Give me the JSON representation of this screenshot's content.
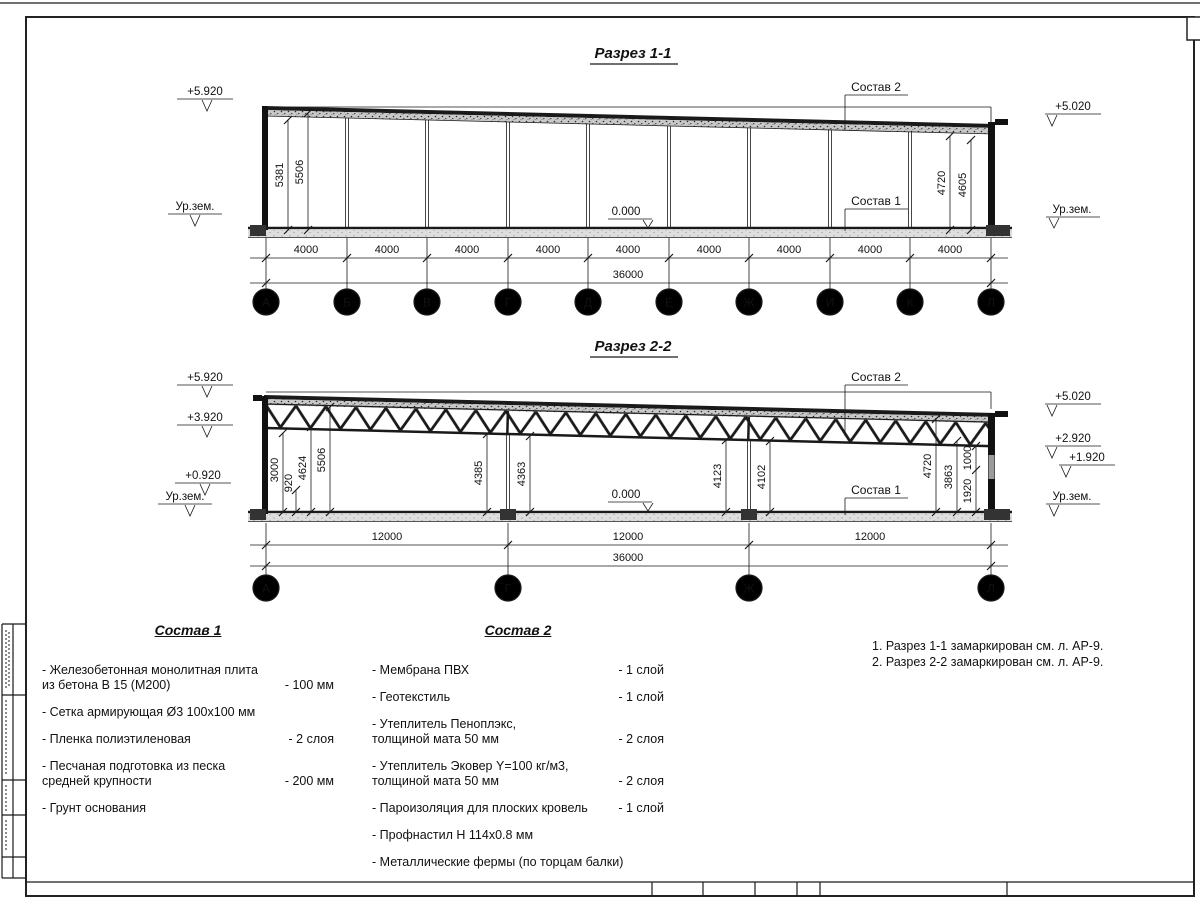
{
  "s1": {
    "title": "Разрез 1-1",
    "elev": {
      "left_top": "+5.920",
      "left_ground": "Ур.зем.",
      "right_top": "+5.020",
      "right_ground": "Ур.зем."
    },
    "zero": "0.000",
    "roof_label": "Состав 2",
    "floor_label": "Состав 1",
    "vdims": {
      "d5381": "5381",
      "d5506": "5506",
      "d4720": "4720",
      "d4605": "4605"
    },
    "bays": [
      "4000",
      "4000",
      "4000",
      "4000",
      "4000",
      "4000",
      "4000",
      "4000",
      "4000"
    ],
    "total": "36000",
    "axes": [
      "А",
      "Б",
      "В",
      "Г",
      "Д",
      "Е",
      "Ж",
      "И",
      "К",
      "Л"
    ]
  },
  "s2": {
    "title": "Разрез 2-2",
    "elev": {
      "left": [
        "+5.920",
        "+3.920",
        "+0.920"
      ],
      "left_ground": "Ур.зем.",
      "right": [
        "+5.020",
        "+2.920",
        "+1.920"
      ],
      "right_ground": "Ур.зем."
    },
    "zero": "0.000",
    "roof_label": "Состав 2",
    "floor_label": "Состав 1",
    "vdims": [
      "3000",
      "920",
      "4624",
      "5506",
      "4385",
      "4363",
      "4123",
      "4102",
      "4720",
      "3863",
      "1000",
      "1920"
    ],
    "bays": [
      "12000",
      "12000",
      "12000"
    ],
    "total": "36000",
    "axes": [
      "А",
      "Г",
      "Ж",
      "Л"
    ]
  },
  "sostav1": {
    "title": "Состав 1",
    "items": [
      {
        "name": "- Железобетонная  монолитная плита\nиз бетона В 15 (М200)",
        "value": "- 100 мм"
      },
      {
        "name": "- Сетка армирующая Ø3 100x100 мм",
        "value": ""
      },
      {
        "name": "- Пленка полиэтиленовая",
        "value": "- 2 слоя"
      },
      {
        "name": "- Песчаная подготовка из песка\nсредней крупности",
        "value": "- 200 мм"
      },
      {
        "name": "- Грунт основания",
        "value": ""
      }
    ]
  },
  "sostav2": {
    "title": "Состав 2",
    "items": [
      {
        "name": "- Мембрана ПВХ",
        "value": "- 1 слой"
      },
      {
        "name": "- Геотекстиль",
        "value": "- 1 слой"
      },
      {
        "name": "- Утеплитель Пеноплэкс,\nтолщиной мата 50 мм",
        "value": "- 2 слоя"
      },
      {
        "name": "- Утеплитель Эковер Y=100 кг/м3,\nтолщиной мата 50 мм",
        "value": "- 2 слоя"
      },
      {
        "name": "- Пароизоляция для плоских кровель",
        "value": "- 1 слой"
      },
      {
        "name": "- Профнастил Н 114х0.8 мм",
        "value": ""
      },
      {
        "name": "- Металлические фермы (по торцам балки)",
        "value": ""
      }
    ]
  },
  "notes": [
    "1. Разрез 1-1 замаркирован см. л. АР-9.",
    "2. Разрез 2-2 замаркирован см. л. АР-9."
  ]
}
